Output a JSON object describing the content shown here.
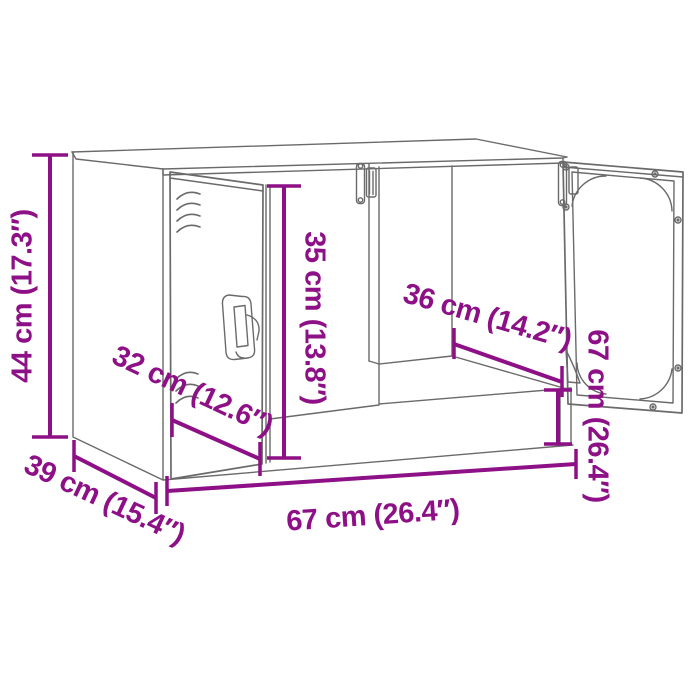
{
  "colors": {
    "accent": "#8e1086",
    "line": "#6a6a6a",
    "background": "#ffffff"
  },
  "dimensions": [
    {
      "id": "overall-height",
      "label": "44 cm (17.3″)"
    },
    {
      "id": "inner-height",
      "label": "35 cm (13.8″)"
    },
    {
      "id": "door-depth",
      "label": "32 cm (12.6″)"
    },
    {
      "id": "inner-depth",
      "label": "36 cm (14.2″)"
    },
    {
      "id": "width-right",
      "label": "67 cm (26.4″)"
    },
    {
      "id": "overall-depth",
      "label": "39 cm (15.4″)"
    },
    {
      "id": "overall-width",
      "label": "67 cm (26.4″)"
    }
  ]
}
